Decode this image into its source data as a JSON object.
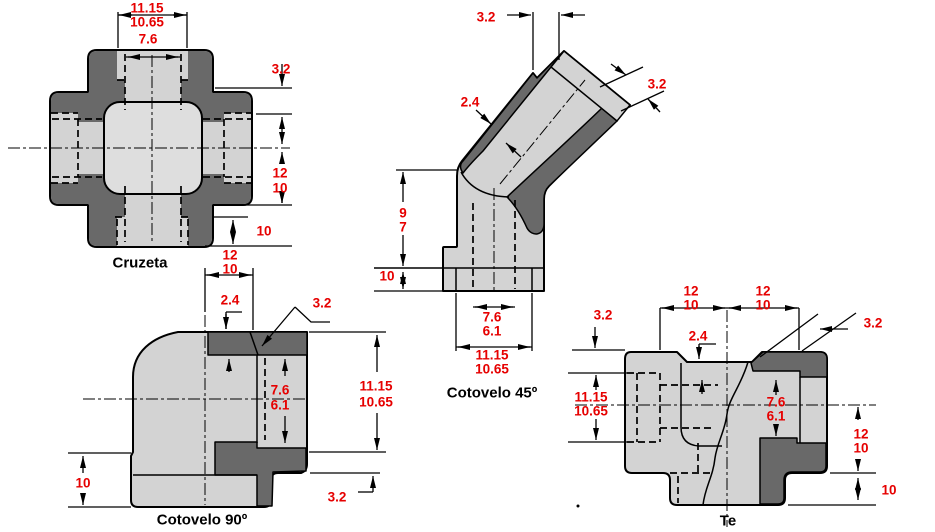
{
  "colors": {
    "dim_text": "#e60000",
    "body_dark": "#696969",
    "body_light": "#d3d3d3",
    "body_lighter": "#dedede",
    "line": "#000000",
    "background": "#ffffff"
  },
  "cruzeta": {
    "caption": "Cruzeta",
    "dims": {
      "outer_max": "11.15",
      "outer_min": "10.65",
      "bore": "7.6",
      "wall": "3.2",
      "center_max": "12",
      "center_min": "10",
      "depth": "10"
    }
  },
  "cotovelo90": {
    "caption": "Cotovelo 90º",
    "dims": {
      "top_max": "12",
      "top_min": "10",
      "step": "2.4",
      "chamfer": "3.2",
      "bore_max": "7.6",
      "bore_min": "6.1",
      "socket_max": "11.15",
      "socket_min": "10.65",
      "base": "10",
      "bottom_wall": "3.2"
    }
  },
  "cotovelo45": {
    "caption": "Cotovelo 45º",
    "dims": {
      "gap": "3.2",
      "end_wall": "3.2",
      "wall": "2.4",
      "height_max": "9",
      "height_min": "7",
      "base": "10",
      "bore_max": "7.6",
      "bore_min": "6.1",
      "socket_max": "11.15",
      "socket_min": "10.65"
    }
  },
  "te": {
    "caption": "Te",
    "dims": {
      "left_max": "12",
      "left_min": "10",
      "right_max": "12",
      "right_min": "10",
      "wall": "3.2",
      "chamfer": "3.2",
      "step": "2.4",
      "socket_max": "11.15",
      "socket_min": "10.65",
      "bore_max": "7.6",
      "bore_min": "6.1",
      "side_max": "12",
      "side_min": "10",
      "depth": "10"
    }
  },
  "misc": {
    "stray_dot": "."
  }
}
